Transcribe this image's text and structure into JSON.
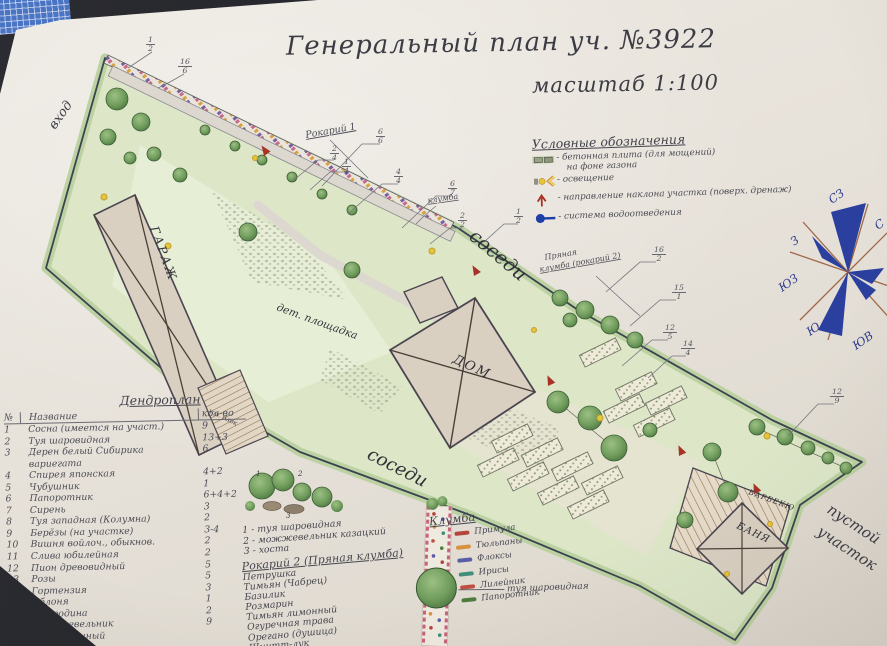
{
  "title": {
    "main": "Генеральный план уч. №3922",
    "scale": "масштаб 1:100"
  },
  "legend": {
    "title": "Условные обозначения",
    "items": [
      {
        "line1": "- бетонная плита (для мощений)",
        "line2": "на фоне газона"
      },
      {
        "label": "- освещение"
      },
      {
        "label": "- направление наклона участка (поверх. дренаж)"
      },
      {
        "label": "- система водоотведения"
      }
    ]
  },
  "compass": {
    "nw": "СЗ",
    "n": "С",
    "w": "З",
    "sw": "ЮЗ",
    "s": "Ю",
    "se": "ЮВ"
  },
  "plan": {
    "entrance": "вход",
    "garage": "ГАРАЖ",
    "shed": "хоз. блок",
    "playground": "дет. площадка",
    "neighbors_top": "соседи",
    "neighbors_bottom": "соседи",
    "house": "ДОМ",
    "sauna": "БАНЯ",
    "bbq": "БАРБЕКЮ",
    "empty_line1": "пустой",
    "empty_line2": "участок",
    "rockery1": "Рокарий 1",
    "flowerbed": "клумба",
    "spicy_line1": "Пряная",
    "spicy_line2": "клумба (рокарий 2)",
    "callouts": [
      {
        "num": "1",
        "den": "2"
      },
      {
        "num": "16",
        "den": "6"
      },
      {
        "num": "6",
        "den": "6"
      },
      {
        "num": "2",
        "den": "4"
      },
      {
        "num": "1",
        "den": "4"
      },
      {
        "num": "4",
        "den": "4"
      },
      {
        "num": "6",
        "den": "7"
      },
      {
        "num": "2",
        "den": "2"
      },
      {
        "num": "1",
        "den": "2"
      },
      {
        "num": "16",
        "den": "2"
      },
      {
        "num": "15",
        "den": "1"
      },
      {
        "num": "12",
        "den": "5"
      },
      {
        "num": "14",
        "den": "4"
      },
      {
        "num": "12",
        "den": "9"
      }
    ]
  },
  "dendroplan": {
    "title": "Дендроплан",
    "header": {
      "no": "№",
      "name": "Название",
      "qty": "кол-во"
    },
    "rows": [
      {
        "n": "1",
        "name": "Сосна (имеется на участ.)",
        "qty": "9"
      },
      {
        "n": "2",
        "name": "Туя шаровидная",
        "qty": "13+3"
      },
      {
        "n": "3",
        "name": "Дерен белый Сибирика",
        "name2": "вариегата",
        "qty": "6"
      },
      {
        "n": "4",
        "name": "Спирея японская",
        "qty": "4+2"
      },
      {
        "n": "5",
        "name": "Чубушник",
        "qty": "1"
      },
      {
        "n": "6",
        "name": "Папоротник",
        "qty": "6+4+2"
      },
      {
        "n": "7",
        "name": "Сирень",
        "qty": "3"
      },
      {
        "n": "8",
        "name": "Туя западная (Колумна)",
        "qty": "2"
      },
      {
        "n": "9",
        "name": "Берёзы (на участке)",
        "qty": "3-4"
      },
      {
        "n": "10",
        "name": "Вишня войлоч., обыкнов.",
        "qty": "2"
      },
      {
        "n": "11",
        "name": "Слива юбилейная",
        "qty": "2"
      },
      {
        "n": "12",
        "name": "Пион древовидный",
        "qty": "5"
      },
      {
        "n": "13",
        "name": "Розы",
        "qty": "5"
      },
      {
        "n": "14",
        "name": "Гортензия",
        "qty": "3"
      },
      {
        "n": "15",
        "name": "Яблоня",
        "qty": "1"
      },
      {
        "n": "16",
        "name": "Смородина",
        "qty": "2"
      },
      {
        "n": "17",
        "name": "Можжевельник",
        "name2": "обыкновенный",
        "qty": "9"
      }
    ]
  },
  "rockery1": {
    "title": "Рокарий 1",
    "marks": [
      "1",
      "2",
      "3"
    ],
    "items": [
      "1 - туя шаровидная",
      "2 - можжевельник казацкий",
      "3 - хоста"
    ]
  },
  "rockery2": {
    "title": "Рокарий 2 (Пряная клумба)",
    "items": [
      "Петрушка",
      "Тимьян (Чабрец)",
      "Базилик",
      "Розмарин",
      "Тимьян лимонный",
      "Огуречная трава",
      "Орегано (душица)",
      "Шнитт-лук"
    ]
  },
  "flowerbed": {
    "title": "Клумба",
    "items": [
      {
        "label": "Примула",
        "color": "#b5443c"
      },
      {
        "label": "Тюльпаны",
        "color": "#d8913f"
      },
      {
        "label": "Флоксы",
        "color": "#5b5ea6"
      },
      {
        "label": "Ирисы",
        "color": "#3f8f7a"
      },
      {
        "label": "Лилейник",
        "color": "#c05044"
      },
      {
        "label": "Папоротник",
        "color": "#4e7d3e"
      }
    ],
    "pointer_label": "туя шаровидная"
  },
  "colors": {
    "paper": "#e9e4dc",
    "ink": "#3c3c45",
    "plot_lawn": "#dde7c8",
    "plot_edge": "#bcd2a2",
    "compass_blue": "#2b3f9e",
    "light_yellow": "#e4c63a",
    "slope_red": "#a83226",
    "drain_blue": "#1d3fa8"
  }
}
